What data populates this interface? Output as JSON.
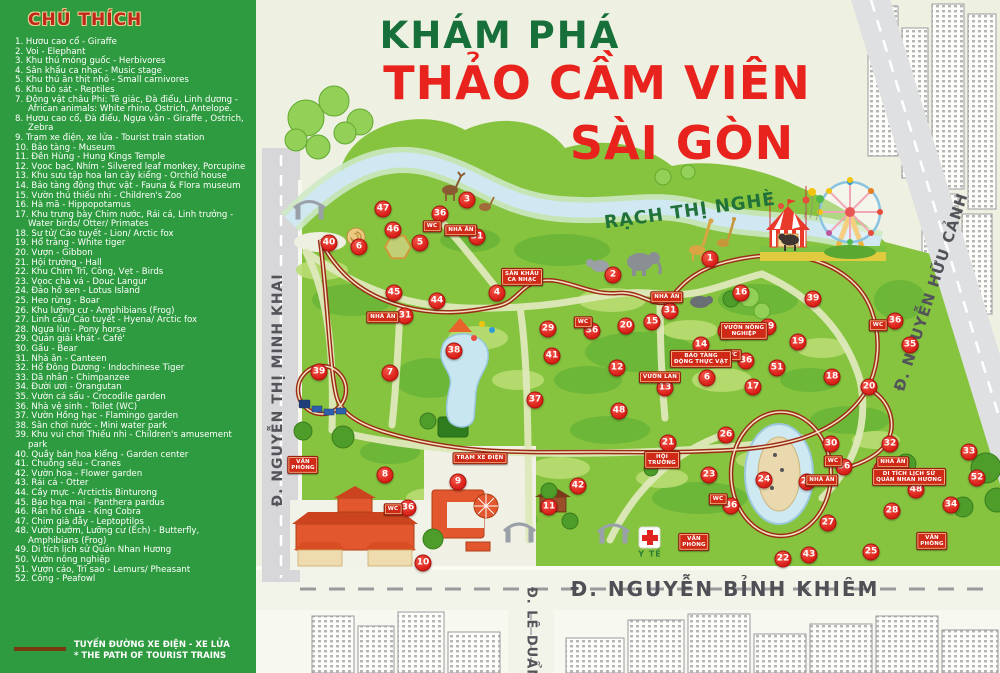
{
  "legend": {
    "title": "CHÚ THÍCH",
    "items": [
      "1. Hươu cao cổ - Giraffe",
      "2. Voi - Elephant",
      "3. Khu thú móng guốc - Herbivores",
      "4. Sân khấu ca nhạc - Music stage",
      "5. Khu thú ăn thịt nhỏ - Small carnivores",
      "6. Khu bò sát - Reptiles",
      "7. Động vật châu Phi: Tê giác, Đà điểu, Linh dương - African animals: White rhino, Ostrich, Antelope.",
      "8. Hươu cao cổ, Đà điểu, Ngựa vằn - Giraffe , Ostrich, Zebra",
      "9. Trạm xe điện, xe lửa - Tourist train station",
      "10. Bảo tàng - Museum",
      "11. Đền Hùng - Hung Kings Temple",
      "12. Vọoc bạc, Nhím - Silvered leaf monkey, Porcupine",
      "13. Khu sưu tập hoa lan cây kiểng - Orchid house",
      "14. Bảo tàng động thực vật - Fauna & Flora museum",
      "15. Vườn thú thiếu nhi - Children's Zoo",
      "16. Hà mã - Hippopotamus",
      "17. Khu trưng bày Chim nước, Rái cá, Linh trưởng - Water birds/ Otter/ Primates",
      "18. Sư tử/ Cáo tuyết - Lion/ Arctic fox",
      "19. Hổ trắng - White tiger",
      "20. Vượn - Gibbon",
      "21. Hội trường - Hall",
      "22. Khu Chim Trĩ, Công, Vẹt - Birds",
      "23. Vọoc chà vá - Douc Langur",
      "24. Đảo hồ sen - Lotus Island",
      "25. Heo rừng - Boar",
      "26. Khu lưỡng cư - Amphibians (Frog)",
      "27. Linh cẩu/ Cáo tuyết - Hyena/ Arctic fox",
      "28. Ngựa lùn - Pony horse",
      "29. Quán giải khát - Café'",
      "30. Gấu - Bear",
      "31. Nhà ăn - Canteen",
      "32. Hổ Đông Dương - Indochinese Tiger",
      "33. Dã nhân - Chimpanzee",
      "34. Đười ươi - Orangutan",
      "35. Vườn cá sấu - Crocodile garden",
      "36. Nhà vệ sinh - Toilet (WC)",
      "37. Vườn Hồng hạc - Flamingo garden",
      "38. Sân chơi nước - Mini water park",
      "39. Khu vui chơi Thiếu nhi - Children's amusement park",
      "40. Quầy bán hoa kiểng - Garden center",
      "41. Chuồng sếu - Cranes",
      "42. Vườn hoa - Flower garden",
      "43. Rái cá - Otter",
      "44. Cầy mực - Arctictis Binturong",
      "45. Báo hoa mai - Panthera pardus",
      "46. Rắn hổ chúa - King Cobra",
      "47. Chim già đẫy - Leptoptilos",
      "48. Vườn bướm, Lưỡng cư (Ếch) - Butterfly, Amphibians (Frog)",
      "49. Di tích lịch sử Quán Nhan Hương",
      "50. Vườn nông nghiệp",
      "51. Vượn cáo, Trĩ sao - Lemurs/ Pheasant",
      "52. Công - Peafowl"
    ],
    "footer_line1": "TUYẾN ĐƯỜNG XE ĐIỆN - XE LỬA",
    "footer_line2": "* THE PATH OF TOURIST TRAINS"
  },
  "title": {
    "line1": "KHÁM PHÁ",
    "line2": "THẢO CẦM VIÊN",
    "line3": "SÀI GÒN"
  },
  "map": {
    "river_label": "RẠCH THỊ NGHÈ",
    "medical_label": "Y TẾ",
    "streets": {
      "minh_khai": "Đ. NGUYỄN THỊ MINH KHAI",
      "huu_canh": "Đ. NGUYỄN HỮU CẢNH",
      "binh_khiem": "Đ. NGUYỄN BỈNH KHIÊM",
      "le_duan": "Đ. LÊ DUẨN"
    },
    "markers": [
      {
        "n": "1",
        "x": 710,
        "y": 259
      },
      {
        "n": "2",
        "x": 613,
        "y": 275
      },
      {
        "n": "3",
        "x": 467,
        "y": 200
      },
      {
        "n": "4",
        "x": 497,
        "y": 293
      },
      {
        "n": "5",
        "x": 420,
        "y": 243
      },
      {
        "n": "6",
        "x": 359,
        "y": 247
      },
      {
        "n": "6",
        "x": 707,
        "y": 378
      },
      {
        "n": "7",
        "x": 390,
        "y": 373
      },
      {
        "n": "8",
        "x": 385,
        "y": 475
      },
      {
        "n": "9",
        "x": 458,
        "y": 482
      },
      {
        "n": "10",
        "x": 423,
        "y": 563
      },
      {
        "n": "11",
        "x": 549,
        "y": 507
      },
      {
        "n": "12",
        "x": 617,
        "y": 368
      },
      {
        "n": "13",
        "x": 665,
        "y": 388
      },
      {
        "n": "14",
        "x": 701,
        "y": 345
      },
      {
        "n": "15",
        "x": 652,
        "y": 322
      },
      {
        "n": "16",
        "x": 741,
        "y": 293
      },
      {
        "n": "17",
        "x": 753,
        "y": 387
      },
      {
        "n": "18",
        "x": 832,
        "y": 377
      },
      {
        "n": "19",
        "x": 798,
        "y": 342
      },
      {
        "n": "20",
        "x": 626,
        "y": 326
      },
      {
        "n": "20",
        "x": 869,
        "y": 387
      },
      {
        "n": "21",
        "x": 668,
        "y": 443
      },
      {
        "n": "22",
        "x": 783,
        "y": 559
      },
      {
        "n": "23",
        "x": 709,
        "y": 475
      },
      {
        "n": "24",
        "x": 764,
        "y": 480
      },
      {
        "n": "25",
        "x": 871,
        "y": 552
      },
      {
        "n": "26",
        "x": 726,
        "y": 435
      },
      {
        "n": "27",
        "x": 828,
        "y": 523
      },
      {
        "n": "28",
        "x": 892,
        "y": 511
      },
      {
        "n": "29",
        "x": 548,
        "y": 329
      },
      {
        "n": "29",
        "x": 807,
        "y": 482
      },
      {
        "n": "29",
        "x": 882,
        "y": 469
      },
      {
        "n": "30",
        "x": 831,
        "y": 444
      },
      {
        "n": "31",
        "x": 477,
        "y": 237
      },
      {
        "n": "31",
        "x": 405,
        "y": 316
      },
      {
        "n": "31",
        "x": 670,
        "y": 311
      },
      {
        "n": "32",
        "x": 890,
        "y": 444
      },
      {
        "n": "33",
        "x": 969,
        "y": 452
      },
      {
        "n": "34",
        "x": 951,
        "y": 505
      },
      {
        "n": "35",
        "x": 910,
        "y": 345
      },
      {
        "n": "36",
        "x": 440,
        "y": 214
      },
      {
        "n": "36",
        "x": 592,
        "y": 331
      },
      {
        "n": "36",
        "x": 895,
        "y": 321
      },
      {
        "n": "36",
        "x": 746,
        "y": 361
      },
      {
        "n": "36",
        "x": 844,
        "y": 467
      },
      {
        "n": "36",
        "x": 731,
        "y": 506
      },
      {
        "n": "36",
        "x": 408,
        "y": 508
      },
      {
        "n": "37",
        "x": 535,
        "y": 400
      },
      {
        "n": "38",
        "x": 454,
        "y": 351
      },
      {
        "n": "39",
        "x": 319,
        "y": 372
      },
      {
        "n": "39",
        "x": 813,
        "y": 299
      },
      {
        "n": "39",
        "x": 768,
        "y": 327
      },
      {
        "n": "40",
        "x": 329,
        "y": 243
      },
      {
        "n": "41",
        "x": 552,
        "y": 356
      },
      {
        "n": "42",
        "x": 578,
        "y": 486
      },
      {
        "n": "43",
        "x": 809,
        "y": 555
      },
      {
        "n": "44",
        "x": 437,
        "y": 301
      },
      {
        "n": "45",
        "x": 394,
        "y": 293
      },
      {
        "n": "46",
        "x": 393,
        "y": 230
      },
      {
        "n": "47",
        "x": 383,
        "y": 209
      },
      {
        "n": "48",
        "x": 619,
        "y": 411
      },
      {
        "n": "48",
        "x": 916,
        "y": 490
      },
      {
        "n": "50",
        "x": 726,
        "y": 331
      },
      {
        "n": "51",
        "x": 777,
        "y": 368
      },
      {
        "n": "52",
        "x": 977,
        "y": 478
      }
    ],
    "signs": [
      {
        "t": "WC",
        "x": 432,
        "y": 226
      },
      {
        "t": "WC",
        "x": 583,
        "y": 322
      },
      {
        "t": "WC",
        "x": 878,
        "y": 325
      },
      {
        "t": "WC",
        "x": 732,
        "y": 355
      },
      {
        "t": "WC",
        "x": 833,
        "y": 461
      },
      {
        "t": "WC",
        "x": 718,
        "y": 499
      },
      {
        "t": "WC",
        "x": 393,
        "y": 509
      },
      {
        "t": "NHÀ ĂN",
        "x": 461,
        "y": 230
      },
      {
        "t": "NHÀ ĂN",
        "x": 383,
        "y": 317
      },
      {
        "t": "NHÀ ĂN",
        "x": 667,
        "y": 297
      },
      {
        "t": "NHÀ ĂN",
        "x": 893,
        "y": 462
      },
      {
        "t": "NHÀ ĂN",
        "x": 822,
        "y": 480
      },
      {
        "t": "SÂN KHẤU\nCA NHẠC",
        "x": 522,
        "y": 277
      },
      {
        "t": "HỘI\nTRƯỜNG",
        "x": 662,
        "y": 460
      },
      {
        "t": "VĂN\nPHÒNG",
        "x": 303,
        "y": 465
      },
      {
        "t": "VĂN\nPHÒNG",
        "x": 694,
        "y": 542
      },
      {
        "t": "VĂN\nPHÒNG",
        "x": 932,
        "y": 541
      },
      {
        "t": "TRẠM XE ĐIỆN",
        "x": 480,
        "y": 458
      },
      {
        "t": "BẢO TÀNG\nĐỘNG THỰC VẬT",
        "x": 701,
        "y": 359
      },
      {
        "t": "VƯỜN NÔNG\nNGHIỆP",
        "x": 744,
        "y": 331
      },
      {
        "t": "VƯỜN LAN",
        "x": 660,
        "y": 377
      },
      {
        "t": "DI TÍCH LỊCH SỬ\nQUÁN NHAN HƯƠNG",
        "x": 909,
        "y": 477
      }
    ]
  },
  "colors": {
    "legend_green": "#2f9b40",
    "map_cream": "#eef0e1",
    "park_green": "#86c440",
    "marker_red": "#d81e17",
    "title_green": "#17703a",
    "title_red": "#e8231e",
    "route_brown": "#9c2b15",
    "river_blue": "#cfe8f2",
    "road_gray": "#d7d7d9"
  }
}
